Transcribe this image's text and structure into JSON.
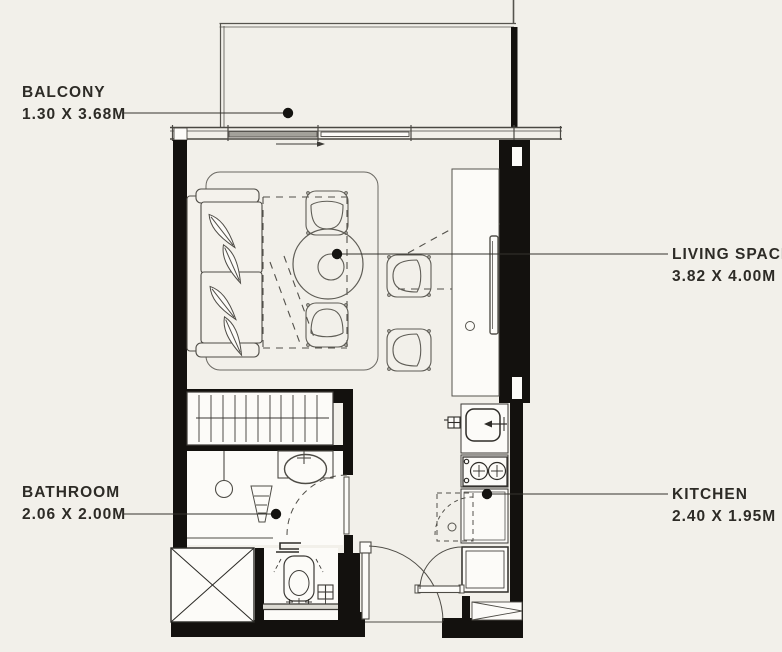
{
  "colors": {
    "background": "#f2f0ea",
    "wall": "#13110e",
    "line": "#4e4c46",
    "furniture": "#5f5d56",
    "text": "#2d2b26",
    "fixture_fill": "#fcfbf8"
  },
  "labels": {
    "balcony": {
      "name": "BALCONY",
      "dims": "1.30 X 3.68M"
    },
    "living_space": {
      "name": "LIVING SPACE",
      "dims": "3.82 X 4.00M"
    },
    "bathroom": {
      "name": "BATHROOM",
      "dims": "2.06 X 2.00M"
    },
    "kitchen": {
      "name": "KITCHEN",
      "dims": "2.40 X 1.95M"
    }
  },
  "fixtures": [
    "sofa",
    "area-rug",
    "round-table",
    "dining-chairs",
    "fold-down-bed-outline",
    "tv-console",
    "wardrobe",
    "shower",
    "vanity-sink",
    "toilet",
    "floor-drain",
    "service-shaft",
    "kitchen-sink",
    "gas-stove",
    "kitchen-counter",
    "refrigerator",
    "entrance-door",
    "bathroom-door",
    "kitchen-door",
    "balcony-sliding-door",
    "shoe-cabinet"
  ]
}
